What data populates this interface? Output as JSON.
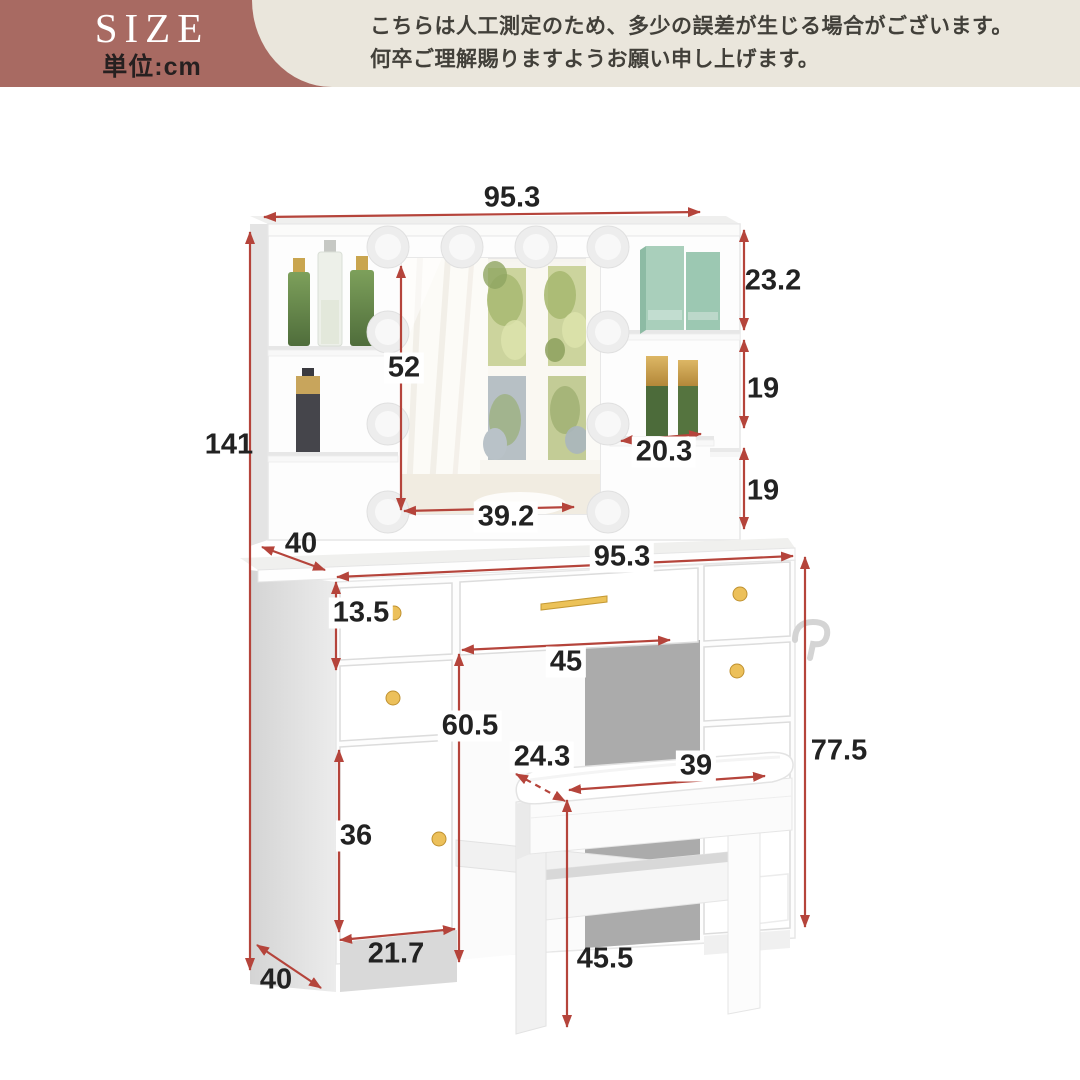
{
  "header": {
    "size_label": "SIZE",
    "unit_label": "単位:cm",
    "disclaimer_line1": "こちらは人工測定のため、多少の誤差が生じる場合がございます。",
    "disclaimer_line2": "何卒ご理解賜りますようお願い申し上げます。"
  },
  "diagram": {
    "subject": "vanity-dresser-with-led-mirror-and-stool",
    "unit": "cm",
    "colors": {
      "banner_mauve": "#a86a62",
      "note_beige": "#eae6dc",
      "dimension_red": "#b5443b",
      "label_black": "#222222",
      "knob_gold": "#ecc05a",
      "shelf_mint": "#a9cfbb",
      "bottle_green": "#5d7d49",
      "furniture_white": "#fdfdfd",
      "shadow_gray": "#ababab"
    },
    "dimensions": [
      {
        "id": "hutch-width",
        "value": "95.3"
      },
      {
        "id": "total-height",
        "value": "141"
      },
      {
        "id": "mirror-height",
        "value": "52"
      },
      {
        "id": "mirror-width",
        "value": "39.2"
      },
      {
        "id": "right-shelf-top-height",
        "value": "23.2"
      },
      {
        "id": "right-shelf-middle-height",
        "value": "19"
      },
      {
        "id": "right-shelf-width",
        "value": "20.3"
      },
      {
        "id": "right-shelf-bottom-height",
        "value": "19"
      },
      {
        "id": "desktop-depth",
        "value": "40"
      },
      {
        "id": "desk-width",
        "value": "95.3"
      },
      {
        "id": "drawer-height",
        "value": "13.5"
      },
      {
        "id": "kneehole-width",
        "value": "45"
      },
      {
        "id": "kneehole-height",
        "value": "60.5"
      },
      {
        "id": "table-height",
        "value": "77.5"
      },
      {
        "id": "cabinet-door-height",
        "value": "36"
      },
      {
        "id": "pedestal-width",
        "value": "21.7"
      },
      {
        "id": "base-depth",
        "value": "40"
      },
      {
        "id": "stool-seat-depth",
        "value": "24.3"
      },
      {
        "id": "stool-seat-width",
        "value": "39"
      },
      {
        "id": "stool-height",
        "value": "45.5"
      }
    ]
  }
}
